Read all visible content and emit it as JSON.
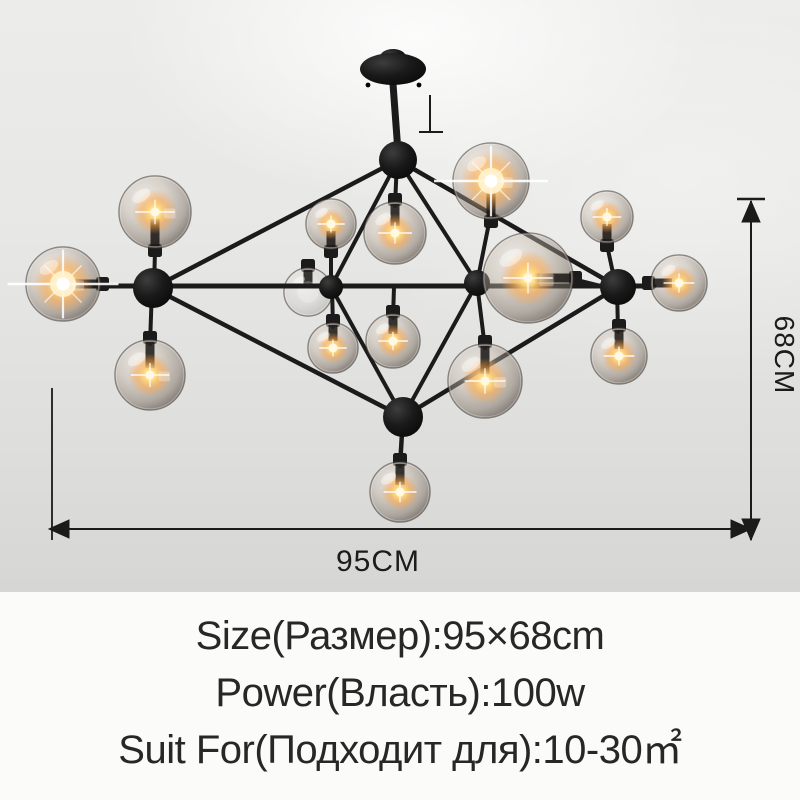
{
  "annotations": {
    "width_label": "95CM",
    "height_label": "68CM"
  },
  "specs": {
    "size": "Size(Размер):95×68cm",
    "power": "Power(Власть):100w",
    "suit": "Suit For(Подходит для):10-30㎡"
  },
  "fixture": {
    "name": "black modo glass globe chandelier",
    "globe_count": 15,
    "frame_color": "#1b1b1b",
    "glass_tint": "#9a8f82",
    "glow_color": "#ffb448"
  },
  "background": {
    "photo_bg": "#e4e4e2",
    "panel_bg": "#fbfbfa",
    "text_color": "#272727"
  }
}
